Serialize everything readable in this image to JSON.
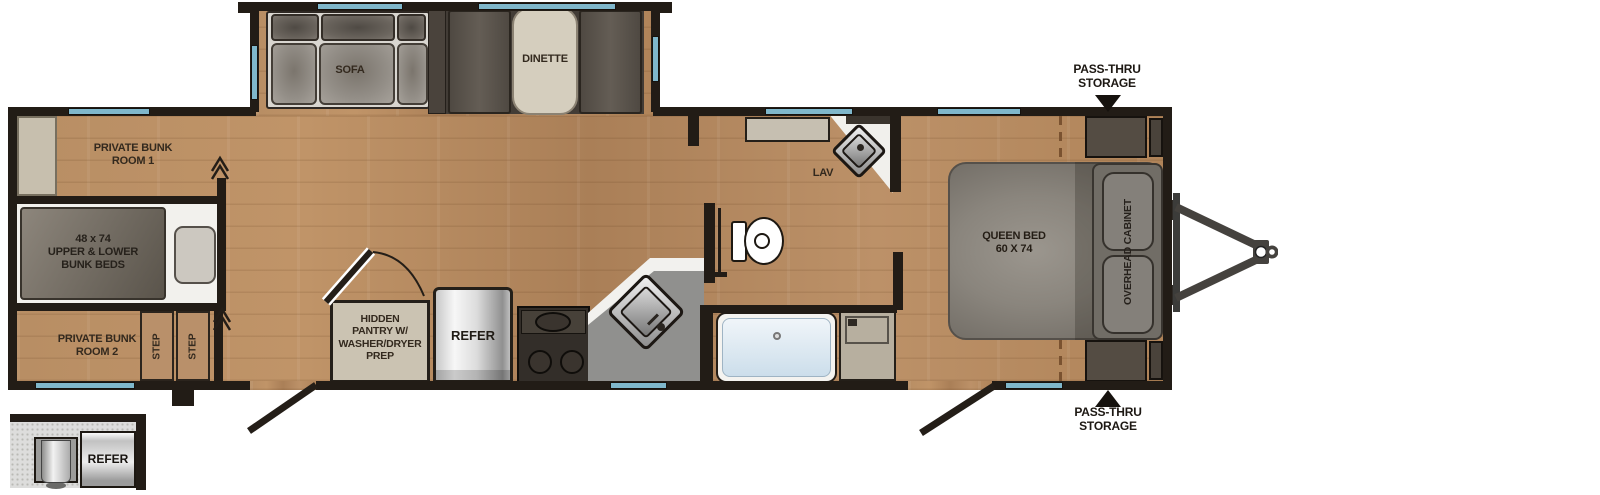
{
  "floorplan": {
    "slideout": {
      "sofa": "SOFA",
      "dinette": "DINETTE"
    },
    "bunk_area": {
      "room1": "PRIVATE BUNK\nROOM 1",
      "bunk_beds": "48 x 74\nUPPER & LOWER\nBUNK BEDS",
      "room2": "PRIVATE BUNK\nROOM 2",
      "step1": "STEP",
      "step2": "STEP"
    },
    "kitchen": {
      "pantry": "HIDDEN\nPANTRY W/\nWASHER/DRYER\nPREP",
      "refer": "REFER"
    },
    "bath": {
      "lav": "LAV"
    },
    "bedroom": {
      "queen_bed": "QUEEN BED\n60 X 74",
      "overhead_cabinet": "OVERHEAD CABINET",
      "pass_thru_top": "PASS-THRU\nSTORAGE",
      "pass_thru_bottom": "PASS-THRU\nSTORAGE"
    },
    "inset": {
      "refer": "REFER"
    },
    "colors": {
      "floor_wood": "#b48a61",
      "wall": "#221c16",
      "window_glass": "#7fb7cb",
      "counter_gray": "#90908e",
      "cabinet_beige": "#cbc3b2",
      "furniture_gray": "#8a857e",
      "label_text": "#33291e"
    }
  }
}
